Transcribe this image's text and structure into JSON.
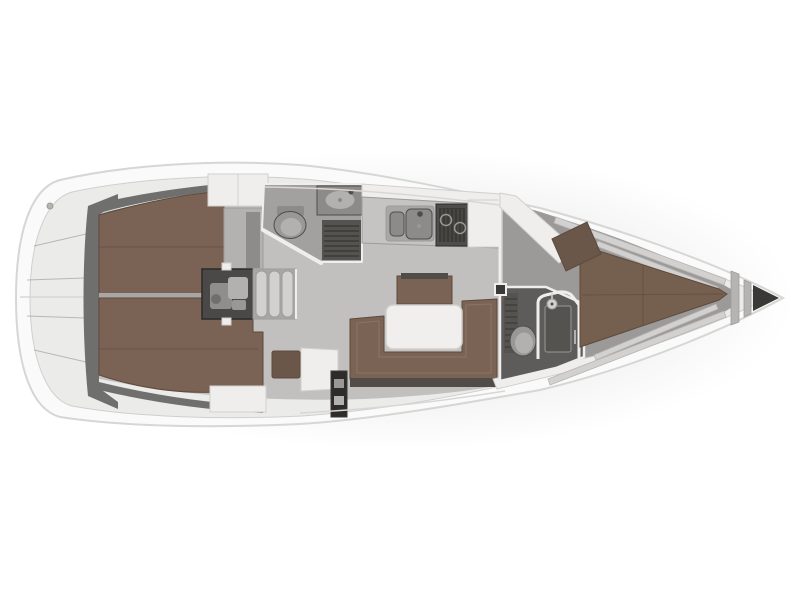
{
  "meta": {
    "subject": "Sailing yacht interior deck plan, top view, bow pointing right",
    "visible_text": "none"
  },
  "palette": {
    "background": "#ffffff",
    "hull": "#fafafa",
    "hull_stroke": "#d6d6d5",
    "deck": "#ebebea",
    "deck_stroke": "#cfcfce",
    "mid_stroke": "#9e9c9a",
    "floor": "#c2c0be",
    "floor_fore": "#9c9a98",
    "wall_dark": "#6f6f6e",
    "berth": "#7a6355",
    "berth_dark": "#5d4a3c",
    "berth_light": "#8f7868",
    "berth_fore": "#75604f",
    "seat_brown": "#6b564a",
    "white_surface": "#efeeec",
    "white_stroke": "#d2d0ce",
    "counter": "#c6c4c2",
    "steel": "#a9a7a5",
    "steel_dark": "#8d8b89",
    "stove": "#4f4d4b",
    "equipment": "#4a4948",
    "equipment_dark": "#2b2a29",
    "equipment_light": "#908e8c",
    "grate": "#55534f",
    "grate_line": "#3c3a37",
    "head_floor_aft": "#a3a1a0",
    "head_floor_fwd": "#5e5c5a",
    "fixture": "#9a9896",
    "fixture_light": "#b3b1af",
    "table": "#f0efed",
    "plinth": "#514c47",
    "post": "#2e2c2a",
    "anchor_locker": "#3b3937",
    "bulkhead": "#b5b4b2",
    "stringer": "#d2d1cf",
    "line_light": "#d8d7d5",
    "wardrobe": "#b4b2b0",
    "wardrobe_panel": "#8e8c8a",
    "shadow": "#9a9a9a"
  },
  "regions": {
    "boat": "Sailing yacht deck plan, bow pointing right",
    "stern_platform": "Stern platform and lazarette storage",
    "aft_cabin_port": "Aft cabin double berth (upper)",
    "aft_cabin_starboard": "Aft cabin double berth (lower)",
    "engine": "Engine compartment",
    "companionway": "Companionway steps",
    "aft_head": "Aft head with toilet, washbasin and shower grate",
    "galley": "Galley with double sink and stove",
    "salon": "Salon with U-shaped settee and table",
    "nav_station": "Chart table and navigator seat",
    "fwd_head": "Forward head with toilet and shower cabin",
    "fwd_cabin": "Forward cabin with V-berth",
    "bow": "Bow compartment with anchor locker"
  },
  "fixtures": {
    "engine_unit": "Diesel engine",
    "steps": "Companionway steps",
    "toilet_aft": "Toilet",
    "washbasin_aft": "Washbasin",
    "shower_grate": "Shower drain grate",
    "double_sink": "Double galley sink",
    "stove": "Stove with two burners",
    "galley_cabinet": "Galley cabinet",
    "sideboard": "Salon sideboard",
    "settee": "U-shaped settee",
    "table": "Salon table",
    "nav_seat": "Navigator seat",
    "chart_table": "Chart table",
    "mast_post": "Mast support post",
    "toilet_fwd": "Toilet",
    "shower_cabin": "Separate shower cabin",
    "shower_head": "Shower head",
    "v_berth": "V-berth double mattress",
    "vanity_seat": "Forward cabin seat",
    "wardrobe": "Wardrobe locker",
    "anchor_locker": "Anchor locker"
  }
}
